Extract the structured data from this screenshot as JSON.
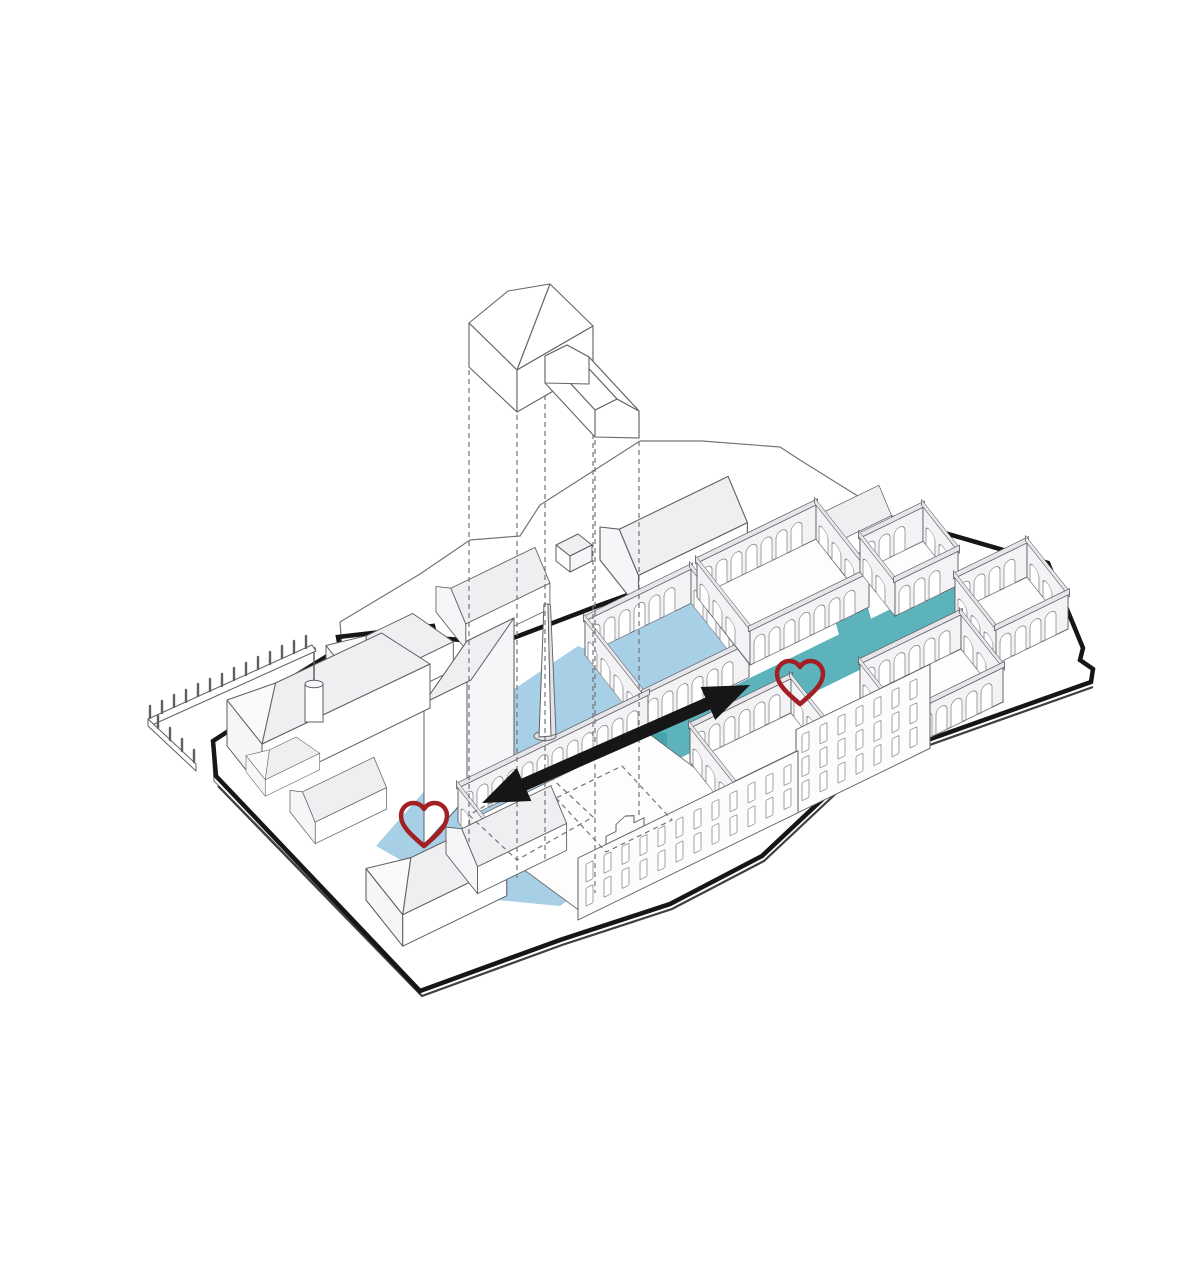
{
  "canvas": {
    "width": 1200,
    "height": 1267
  },
  "colors": {
    "background": "#ffffff",
    "plaza_blue": "#a7cfe6",
    "street_teal": "#5db3bb",
    "street_teal_dark": "#45a3ab",
    "heart_red": "#a21f24",
    "arrow_black": "#161616",
    "boundary_black": "#161616",
    "line_gray": "#5f5f64"
  },
  "icons": {
    "heart_left": "heart-icon",
    "heart_right": "heart-icon",
    "arrow": "double-headed-arrow-icon",
    "obelisk": "obelisk-landmark",
    "floating_building": "lifted-building-volume"
  }
}
